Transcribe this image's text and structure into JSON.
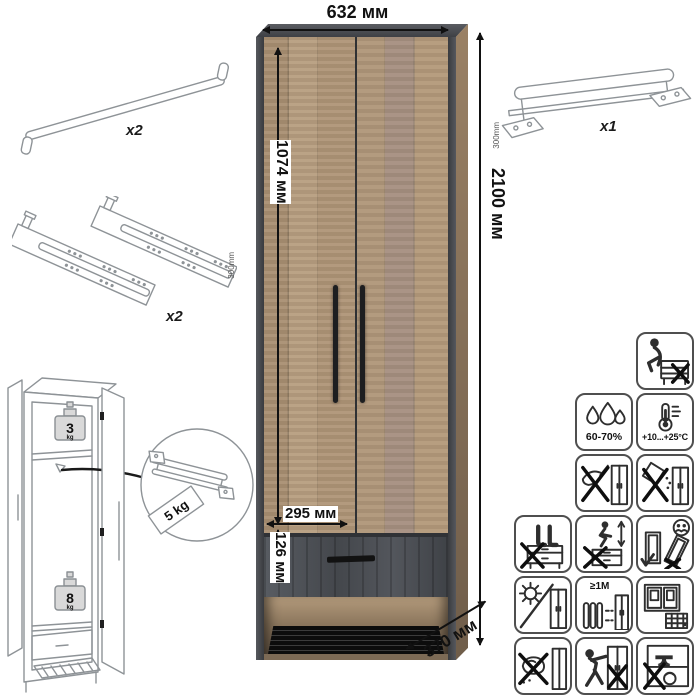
{
  "dims": {
    "width": "632 мм",
    "height": "2100 мм",
    "door_height": "1074 мм",
    "door_width": "295 мм",
    "drawer_height": "126 мм",
    "depth": "370 мм"
  },
  "parts": {
    "door_handle": {
      "qty": "x2"
    },
    "drawer_slides": {
      "qty": "x2",
      "length": "300mm"
    },
    "pullout_rail": {
      "qty": "x1",
      "length": "300mm"
    }
  },
  "load_limits": {
    "top_shelf_value": "3",
    "top_shelf_unit": "kg",
    "rail_tag": "5 kg",
    "bottom_shelf_value": "8",
    "bottom_shelf_unit": "kg"
  },
  "care": {
    "humidity": "60-70%",
    "temperature": "+10...+25°C",
    "heater_distance": "≥1M"
  },
  "icon_names": [
    "no-sitting",
    "humidity-60-70",
    "temperature-range",
    "no-sharp-objects",
    "no-spilling-liquids",
    "no-standing",
    "no-jumping",
    "assemble-upright-two-people",
    "no-direct-sunlight",
    "keep-1m-from-heater",
    "ventilate-room",
    "no-wet-cleaning",
    "no-pushing-dragging",
    "no-heavy-objects"
  ],
  "colors": {
    "wood": "#ac9274",
    "dark_trim": "#43454a",
    "drawer_front": "#4b4e53",
    "handle": "#1d1e20",
    "dimension_text": "#111111",
    "line_drawing": "#8e9397",
    "icon_stroke": "#2e2e2e"
  }
}
